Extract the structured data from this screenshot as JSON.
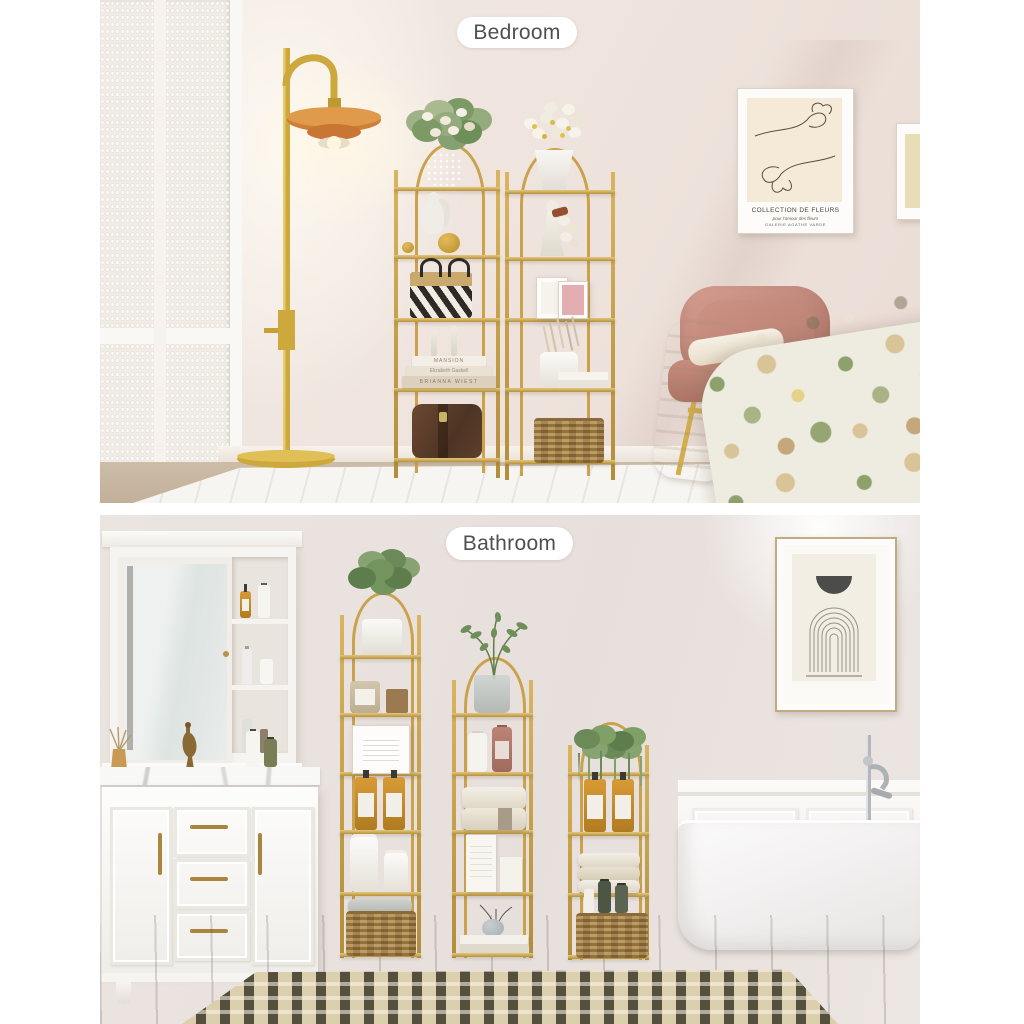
{
  "scene": {
    "top_label": "Bedroom",
    "bottom_label": "Bathroom"
  },
  "bedroom": {
    "wall_art": {
      "title": "COLLECTION DE FLEURS",
      "subtitle": "pour l'amour des fleurs",
      "gallery": "GALERIE AGATHE VARDE"
    },
    "books": {
      "top": "MANSION",
      "middle": "Elizabeth Gaskell",
      "bottom": "BRIANNA WIEST"
    }
  },
  "colors": {
    "gold_frame": "#C9A24B",
    "lamp_shade_amber": "#C97B3A",
    "bedroom_wall": "#EFE5E0",
    "bathroom_wall": "#E7E0DC",
    "chair_pink": "#C88E82",
    "amber_bottle": "#C08A2D",
    "wicker": "#B08D51"
  }
}
